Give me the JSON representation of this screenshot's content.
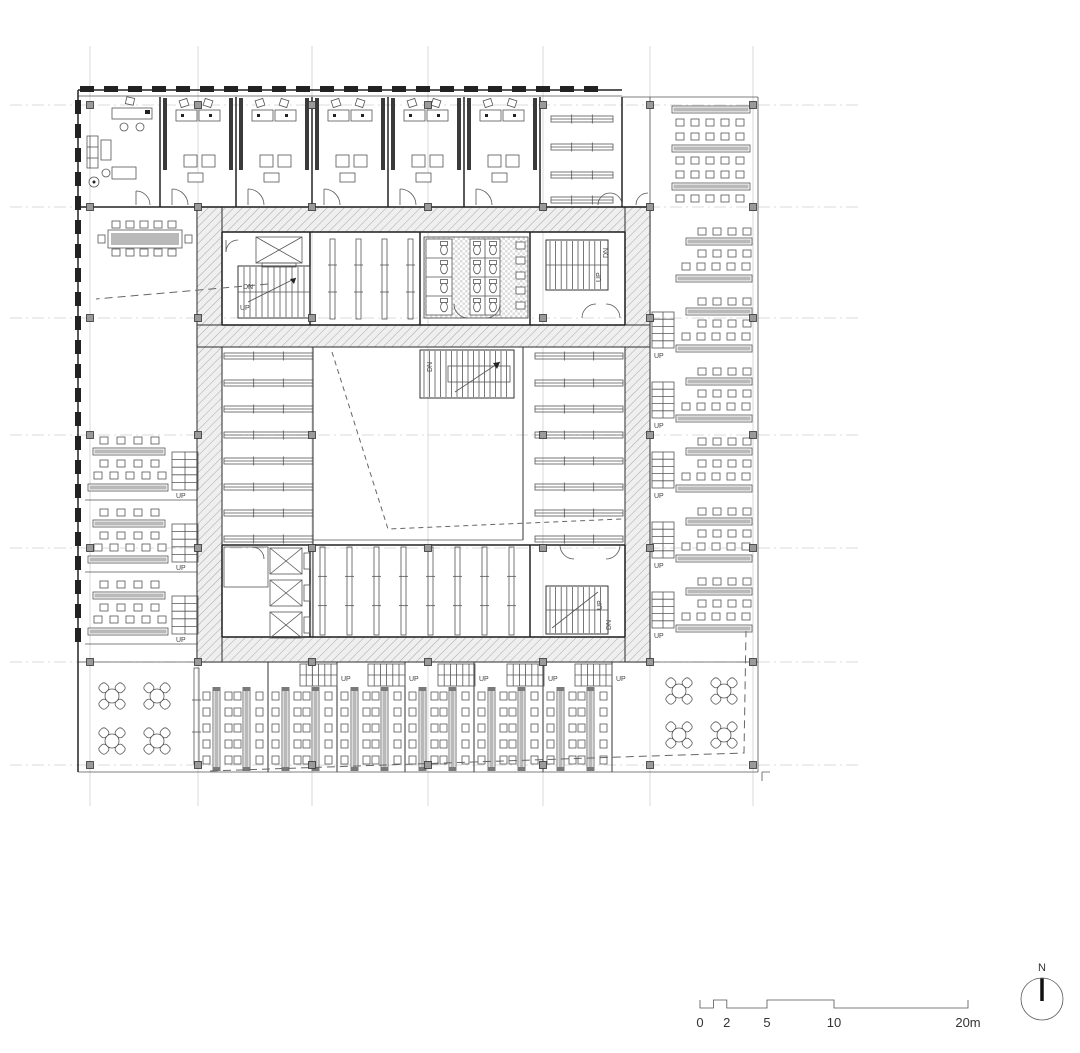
{
  "drawing": {
    "type": "architectural floor plan",
    "description": "Square building floor plan with hatched central service core around an atrium void, cellular offices along the top, reading tables on the left, right and bottom wings, bookshelf stacks around the void, stairs and elevators"
  },
  "labels": {
    "up": "UP",
    "dn": "DN"
  },
  "north_arrow": {
    "label": "N"
  },
  "scale_bar": {
    "tick_labels": [
      "0",
      "2",
      "5",
      "10",
      "20m"
    ],
    "meters": [
      0,
      2,
      5,
      10,
      20
    ],
    "unit": "m"
  },
  "colors": {
    "line": "#222222",
    "thin": "#555555",
    "grid": "#cfcfcf",
    "furniture_gray": "#b9b9b9",
    "column_fill": "#9a9a9a",
    "label": "#444444",
    "site_dash": "#666666",
    "hatch_fill": "#efefef",
    "hatch_line": "#a8a8a8"
  },
  "inventory": {
    "cellular_offices": 5,
    "corner_office": 1,
    "meeting_table": 1,
    "core_stairs": 4,
    "perimeter_stairs": 13,
    "elevators": 4,
    "toilet_stalls": 12,
    "round_tables": 8,
    "bookshelf_rows_per_side": 8,
    "left_reading_blocks": 3,
    "right_reading_blocks": 6,
    "bottom_table_bays": 6
  }
}
